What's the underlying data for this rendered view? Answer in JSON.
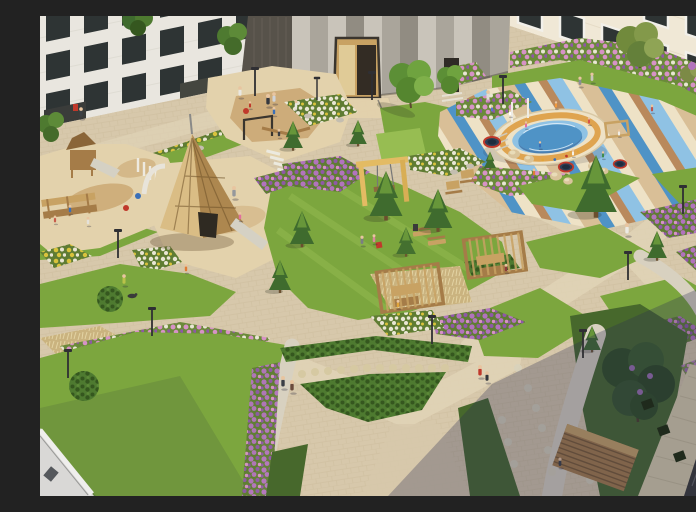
{
  "meta": {
    "description": "Aerial architectural rendering of a landscaped residential courtyard: apartment facades on three sides, sand playgrounds with wooden play equipment, a tall wooden teepee play structure, an oval climbing structure on a blue-and-tan striped play surface with trampolines and climbing domes, a wooden swing frame, pergolas with loungers, spruce and deciduous trees, lawns, purple-pink-yellow flower beds, gravel and paved paths, and people walking and playing."
  },
  "palette": {
    "paving": "#d7c8ab",
    "pavingLine": "#c9b997",
    "pathLight": "#e0d3b6",
    "gravel": "#d8d1c0",
    "sand": "#e3d2ac",
    "sandBrown": "#c9a671",
    "grass": "#7ca63e",
    "grassLight": "#97bd52",
    "grassDark": "#47682c",
    "shrub": "#4e7a30",
    "shrubDark": "#35571f",
    "conifer": "#3f6b2e",
    "coniferLight": "#79a840",
    "flowerGreenBase": "#5f7c33",
    "flowerPurple": "#b273bd",
    "flowerViolet": "#8f58a8",
    "flowerPink": "#d792c6",
    "flowerWhite": "#e9e6d4",
    "flowerYellow": "#d9c33c",
    "dryGrass": "#cab37f",
    "dryGrassLight": "#e3d3a3",
    "wood": "#c8a263",
    "woodDark": "#a57c48",
    "teepeeLight": "#dabd85",
    "teepeeDark": "#ad874f",
    "slide": "#d5d1c4",
    "buildingWhite": "#e9e6df",
    "brickLine": "#d8d5cb",
    "buildingCream": "#f0e8d6",
    "concrete1": "#c9c4ba",
    "concrete2": "#aaa59b",
    "concrete3": "#918c82",
    "concreteDark": "#57524a",
    "windowDark": "#2e3434",
    "frameWhite": "#f2f0ea",
    "splashCream": "#eee2c6",
    "splashOrange": "#dfa44f",
    "splashBlue": "#4f93c6",
    "splashBlueDark": "#2d639b",
    "splashBlueLight": "#8fc2e4",
    "stripeTan": "#d9bf97",
    "stripeBrown": "#b9895c",
    "stripeLightBlue": "#8fc2e4",
    "accentRed": "#c0392b",
    "paverGrey": "#a59e90",
    "facadeDark": "#33343c",
    "skin": "#e8c5a0",
    "shadow": "rgba(44,46,84,0.30)"
  },
  "scene": {
    "buildings": {
      "top_left": "white brick apartment facade with dark windows and ground-floor entrances",
      "top_center": "grey concrete panel block with wooden entrance portal",
      "top_right": "cream apartment facade with white-framed windows",
      "bottom_left": "white building corner",
      "bottom_right": "dark glazed facade with red balcony grilles"
    },
    "features": [
      "wooden teepee play structure",
      "oval climbing bowl on striped safety surface",
      "trampolines",
      "climbing domes",
      "sand playgrounds with wooden tower and slide",
      "wooden swing frame",
      "two pergolas with wooden loungers",
      "wooden deck platform",
      "spruce trees",
      "deciduous trees",
      "lawn hill with seating people",
      "purple, pink, yellow and white flower beds",
      "dry ornamental grass beds",
      "gravel footpaths",
      "paved walkways",
      "lamp posts"
    ]
  }
}
